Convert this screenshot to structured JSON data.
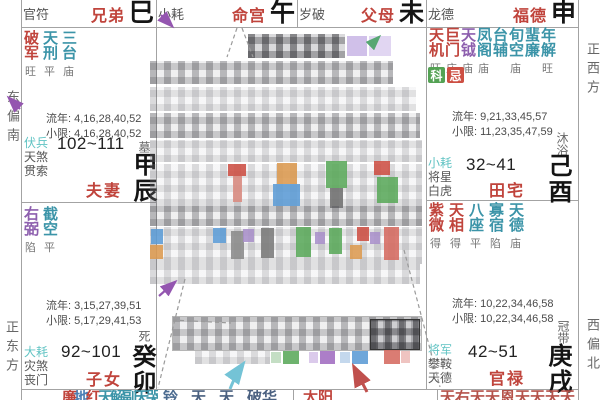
{
  "header_cells": [
    {
      "god": "官符",
      "palace": "兄弟",
      "branch": "巳"
    },
    {
      "god": "小耗",
      "palace": "命宫",
      "branch": "午"
    },
    {
      "god": "岁破",
      "palace": "父母",
      "branch": "未"
    },
    {
      "god": "龙德",
      "palace": "福德",
      "branch": "申"
    }
  ],
  "palaces": {
    "spouse": {
      "stars": [
        {
          "name": "破军",
          "bright": "旺",
          "color": "#c0443c"
        },
        {
          "name": "天刑",
          "bright": "平",
          "color": "#3b94a8"
        },
        {
          "name": "三台",
          "bright": "庙",
          "color": "#3b94a8"
        }
      ],
      "liunian": "流年: 4,16,28,40,52",
      "xiaoxian": "小限: 4,16,28,40,52",
      "gods": [
        {
          "t": "伏兵",
          "c": "#5fc3c3"
        },
        {
          "t": "天煞",
          "c": "#555555"
        },
        {
          "t": "贯索",
          "c": "#555555"
        }
      ],
      "age": "102~111",
      "label": "夫妻",
      "stem": "甲辰",
      "stage": "墓"
    },
    "children": {
      "stars": [
        {
          "name": "右弼",
          "bright": "陷",
          "color": "#8d5fae"
        },
        {
          "name": "截空",
          "bright": "平",
          "color": "#3b94a8"
        }
      ],
      "liunian": "流年: 3,15,27,39,51",
      "xiaoxian": "小限: 5,17,29,41,53",
      "gods": [
        {
          "t": "大耗",
          "c": "#5fc3c3"
        },
        {
          "t": "灾煞",
          "c": "#555555"
        },
        {
          "t": "丧门",
          "c": "#555555"
        }
      ],
      "age": "92~101",
      "label": "子女",
      "stem": "癸卯",
      "stage": "死"
    },
    "property": {
      "stars": [
        {
          "name": "天机",
          "bright": "旺",
          "color": "#c0443c"
        },
        {
          "name": "巨门",
          "bright": "庙",
          "color": "#c0443c"
        },
        {
          "name": "天钺",
          "bright": "庙",
          "color": "#8d5fae"
        },
        {
          "name": "凤阁",
          "bright": "庙",
          "color": "#3b94a8"
        },
        {
          "name": "台辅",
          "bright": "",
          "color": "#3b94a8"
        },
        {
          "name": "旬空",
          "bright": "庙",
          "color": "#3b94a8"
        },
        {
          "name": "蜚廉",
          "bright": "",
          "color": "#3b94a8"
        },
        {
          "name": "年解",
          "bright": "旺",
          "color": "#3b94a8"
        }
      ],
      "badges": [
        {
          "t": "科",
          "bg": "#54a254"
        },
        {
          "t": "忌",
          "bg": "#cd4f43"
        }
      ],
      "liunian": "流年: 9,21,33,45,57",
      "xiaoxian": "小限: 11,23,35,47,59",
      "gods": [
        {
          "t": "小耗",
          "c": "#5fc3c3"
        },
        {
          "t": "将星",
          "c": "#555555"
        },
        {
          "t": "白虎",
          "c": "#555555"
        }
      ],
      "age": "32~41",
      "label": "田宅",
      "stem": "己酉",
      "stage": "沐浴"
    },
    "career": {
      "stars": [
        {
          "name": "紫微",
          "bright": "得",
          "color": "#c0443c"
        },
        {
          "name": "天相",
          "bright": "得",
          "color": "#c0443c"
        },
        {
          "name": "八座",
          "bright": "平",
          "color": "#3b94a8"
        },
        {
          "name": "寡宿",
          "bright": "陷",
          "color": "#3b94a8"
        },
        {
          "name": "天德",
          "bright": "庙",
          "color": "#3b94a8"
        }
      ],
      "liunian": "流年: 10,22,34,46,58",
      "xiaoxian": "小限: 10,22,34,46,58",
      "gods": [
        {
          "t": "将军",
          "c": "#5fc3c3"
        },
        {
          "t": "攀鞍",
          "c": "#555555"
        },
        {
          "t": "天德",
          "c": "#555555"
        }
      ],
      "age": "42~51",
      "label": "官禄",
      "stem": "庚戌",
      "stage": "冠带"
    }
  },
  "bottom_slivers": {
    "s1": [
      {
        "t": "廉",
        "c": "#c0443c"
      },
      {
        "t": "地",
        "c": "#4a7fb5"
      },
      {
        "t": "红",
        "c": "#c0443c"
      },
      {
        "t": "天",
        "c": "#3b94a8"
      },
      {
        "t": "解",
        "c": "#3b94a8"
      },
      {
        "t": "副",
        "c": "#3b94a8"
      },
      {
        "t": "天",
        "c": "#3b94a8"
      },
      {
        "t": "哭",
        "c": "#3b94a8"
      }
    ],
    "s2": [
      {
        "t": "铃",
        "c": "#4a6a8f"
      },
      {
        "t": "天",
        "c": "#4a6080"
      },
      {
        "t": "天",
        "c": "#4a6080"
      },
      {
        "t": "破华",
        "c": "#4a6080"
      }
    ],
    "s3": [
      {
        "t": "太阳",
        "c": "#c0443c"
      }
    ],
    "s4": [
      {
        "t": "天右天天恩天天天天",
        "c": "#b5524a"
      }
    ]
  },
  "directions": {
    "left_top": "东偏南",
    "left_bottom": "正东方",
    "right_top": "正西方",
    "right_bottom": "西偏北"
  },
  "colors": {
    "main_star": "#c0443c",
    "minor_star": "#3b94a8",
    "purple_star": "#8d5fae",
    "god_cyan": "#5fc3c3",
    "badge_ke": "#54a254",
    "badge_ji": "#cd4f43"
  }
}
